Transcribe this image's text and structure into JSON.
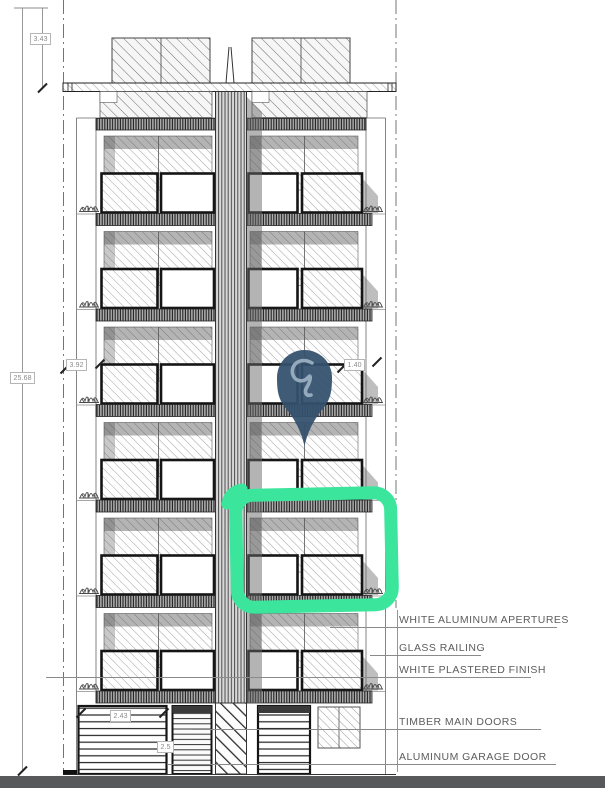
{
  "drawing": {
    "title": "Building front elevation"
  },
  "dimensions": {
    "roof_height": "3.43",
    "total_height": "25.68",
    "level_left": "3.92",
    "level_right": "1.40",
    "garage_width": "2.43",
    "garage_height": "2.5"
  },
  "annotations": {
    "aluminum_apertures": "WHITE ALUMINUM APERTURES",
    "glass_railing": "GLASS RAILING",
    "plastered_finish": "WHITE PLASTERED FINISH",
    "timber_doors": "TIMBER MAIN DOORS",
    "garage_door": "ALUMINUM GARAGE DOOR"
  },
  "markers": {
    "pin_icon": "location-pin",
    "highlight": "selected-unit-highlight"
  },
  "colors": {
    "highlight_green": "#3ce59c",
    "pin_navy": "#33516d",
    "pin_glyph": "#9fb3c4",
    "footer_bar": "#57595b"
  }
}
